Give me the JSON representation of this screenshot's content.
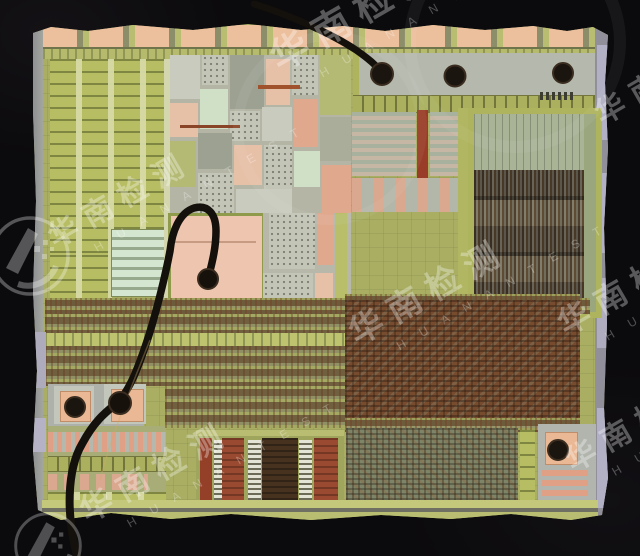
{
  "watermark": {
    "cn": "华南检测",
    "en": "H U A N A N T E S T",
    "color": "#ffffff"
  },
  "die": {
    "base_color": "#a9ae63",
    "pad_copper_color": "#eab894",
    "bond_wire_color": "#14100b",
    "edge_color": "#9a98a2"
  }
}
